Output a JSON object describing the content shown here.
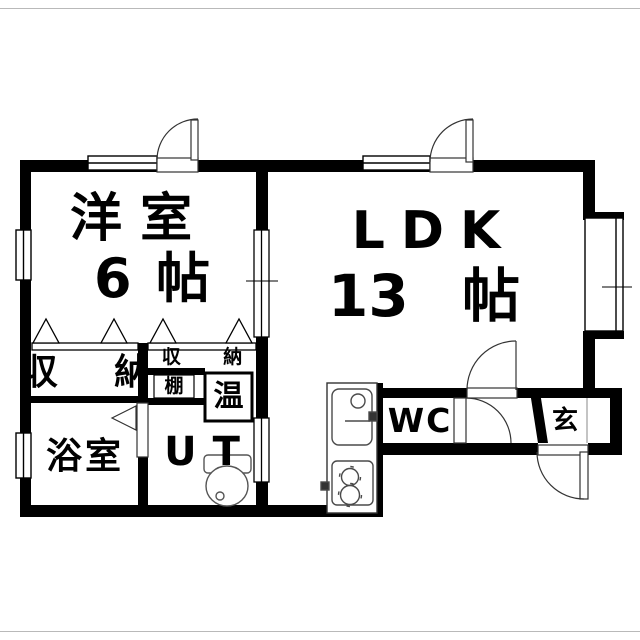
{
  "colors": {
    "wall": "#000000",
    "fixture_line": "#4a4a4a",
    "window_line": "#000000",
    "background": "#ffffff"
  },
  "rooms": {
    "western": {
      "name": "洋 室",
      "size_value": "6",
      "size_unit": "帖"
    },
    "ldk": {
      "name": "LDK",
      "size_value": "13",
      "size_unit": "帖"
    },
    "closet_left": {
      "name": "収 納"
    },
    "closet_right": {
      "name": "収 納"
    },
    "shelf": {
      "name": "棚"
    },
    "water_heater": {
      "name": "温"
    },
    "bathroom": {
      "name": "浴室"
    },
    "utility": {
      "name": "UT"
    },
    "wc": {
      "name": "WC"
    },
    "entrance": {
      "name": "玄"
    }
  }
}
